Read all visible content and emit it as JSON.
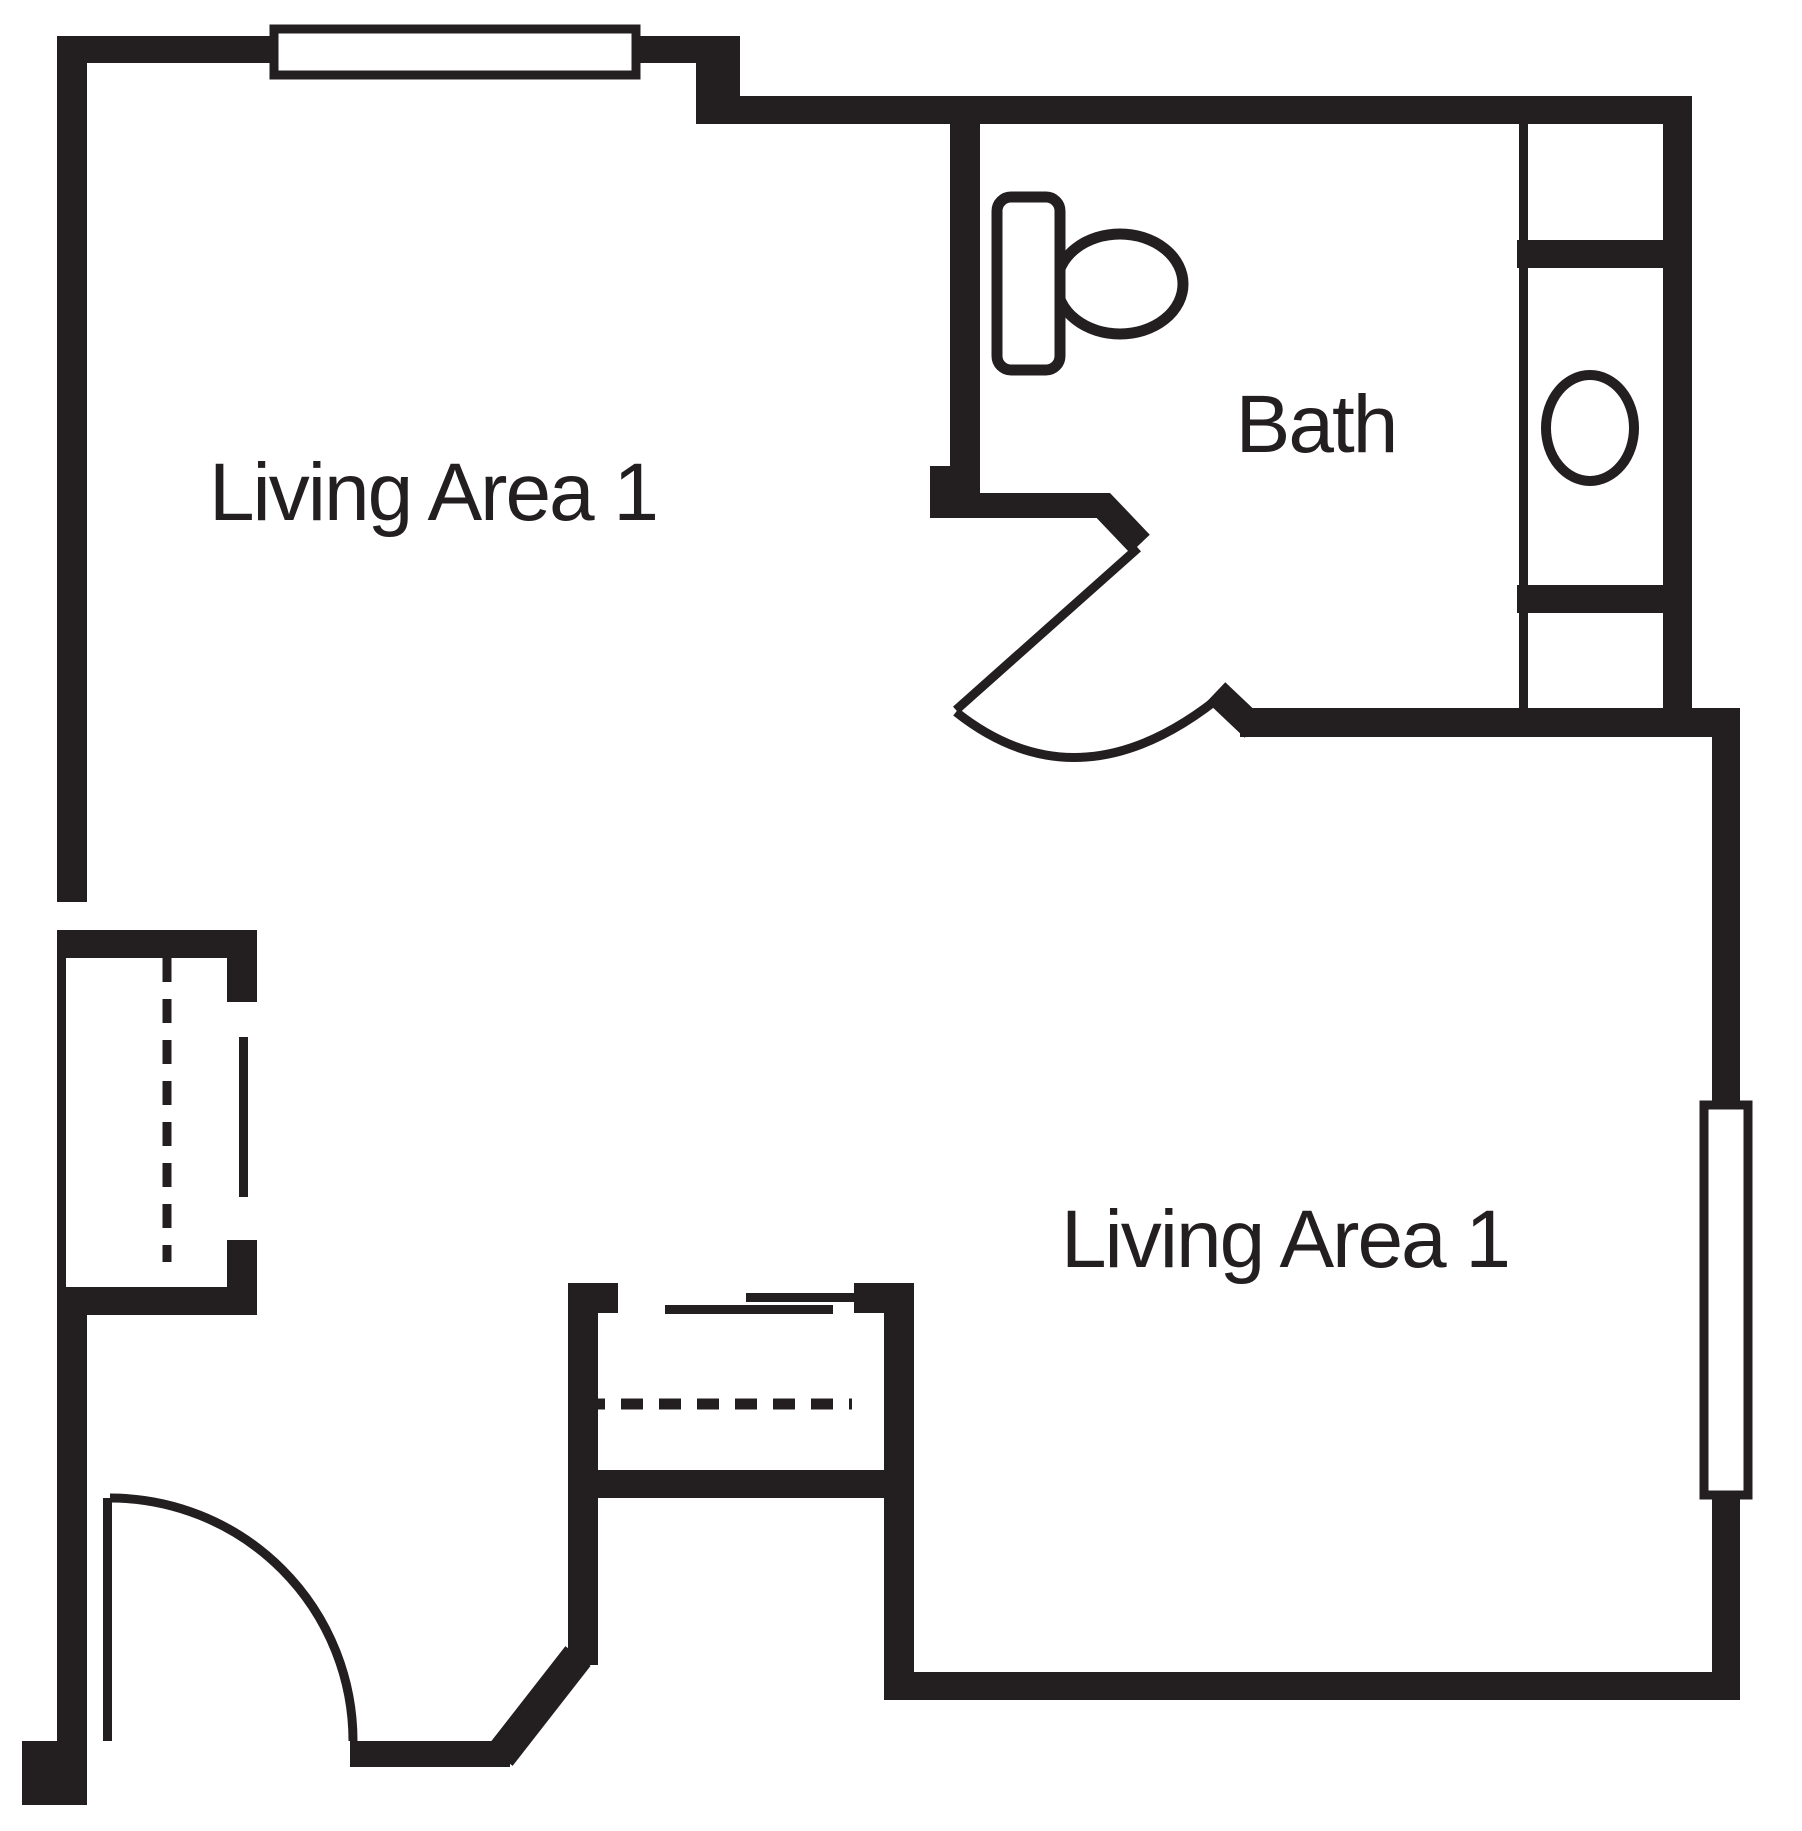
{
  "colors": {
    "ink": "#231f20",
    "background": "#ffffff"
  },
  "rooms": [
    {
      "id": "living-area-top-left",
      "label": "Living Area 1"
    },
    {
      "id": "bath",
      "label": "Bath"
    },
    {
      "id": "living-area-bottom-right",
      "label": "Living Area 1"
    }
  ],
  "fixtures": {
    "toilet": "toilet",
    "sink": "sink-basin-oval",
    "vanity": "vanity-counter",
    "entry_door": "entry-door-swing",
    "bath_door": "bath-door-swing",
    "window_top": "window",
    "window_right": "window",
    "closet_left": "closet-with-sliding-door",
    "closet_center": "closet-with-sliding-doors"
  }
}
